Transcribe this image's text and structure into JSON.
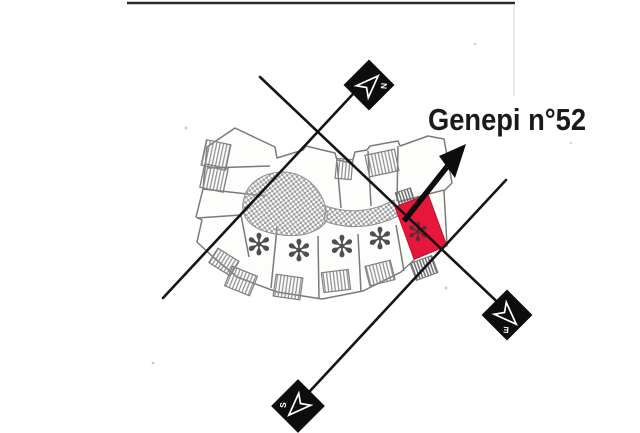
{
  "map": {
    "frame": {
      "border_color": "#2b2b2b"
    },
    "label": {
      "text": "Genepi n°52",
      "color": "#1a1a1a"
    },
    "compass": {
      "north": "N",
      "east": "E",
      "south": "S"
    },
    "building": {
      "asterisk": "✻",
      "outline_color": "#7a7a7a",
      "checker_color": "#9e9e9e",
      "highlight_color": "#e6173a",
      "highlight_asterisk_color": "#6d2433"
    },
    "roads": {
      "color": "#151515"
    },
    "arrow": {
      "color": "#0d0d0d"
    }
  }
}
